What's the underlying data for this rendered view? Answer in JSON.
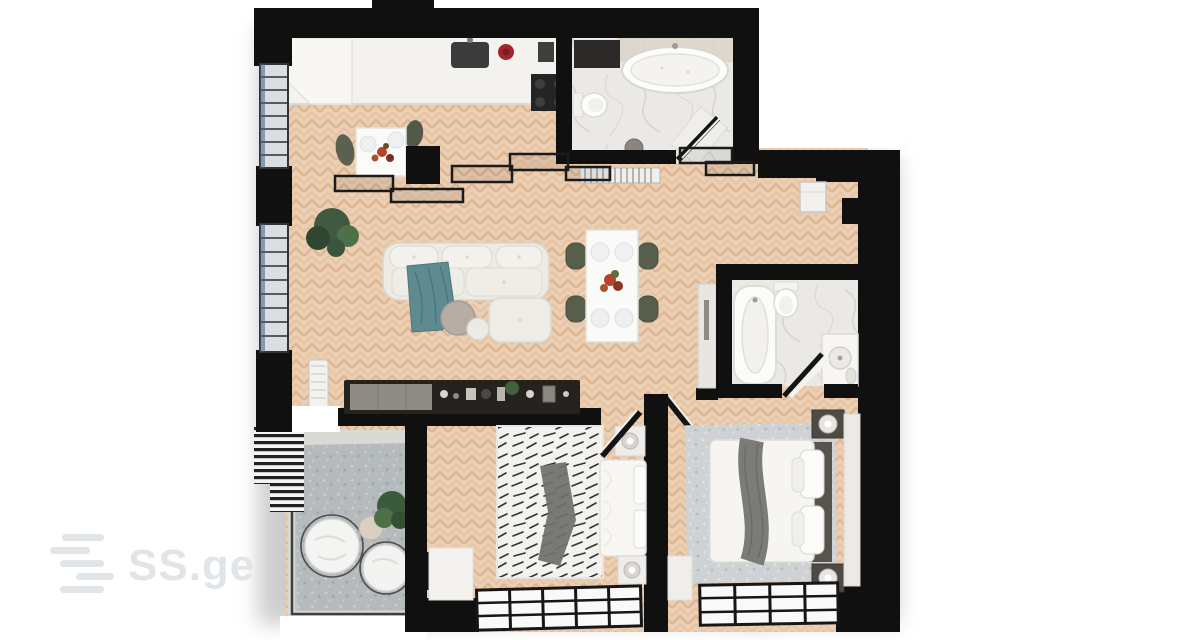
{
  "watermark": {
    "text": "SS.ge",
    "color": "#e2e5e8"
  },
  "scene": {
    "kind": "3d-top-down-floor-plan-render",
    "rooms": [
      {
        "name": "kitchen",
        "furniture": [
          "counter",
          "sink",
          "cooktop",
          "breakfast-table",
          "green-chairs",
          "kettle"
        ]
      },
      {
        "name": "living-room",
        "furniture": [
          "sectional-sofa",
          "teal-throw",
          "coffee-tables",
          "dining-table",
          "dining-chairs",
          "media-console",
          "plant",
          "radiator"
        ]
      },
      {
        "name": "bathroom-top",
        "furniture": [
          "freestanding-oval-tub",
          "toilet",
          "bath-mat",
          "stool",
          "radiator"
        ]
      },
      {
        "name": "entry-hall",
        "furniture": [
          "wall-shelf"
        ]
      },
      {
        "name": "bathroom-side",
        "furniture": [
          "built-in-tub",
          "toilet",
          "vanity-sink",
          "wardrobe"
        ]
      },
      {
        "name": "bedroom-small",
        "furniture": [
          "double-bed",
          "patterned-rug",
          "nightstands",
          "lamps",
          "curtain",
          "window"
        ]
      },
      {
        "name": "bedroom-large",
        "furniture": [
          "double-bed",
          "area-rug",
          "nightstands",
          "lamps",
          "wardrobe",
          "window"
        ]
      },
      {
        "name": "balcony",
        "furniture": [
          "lounge-chairs",
          "side-table",
          "plant",
          "outdoor-rug",
          "pergola-louvers",
          "glass-railing"
        ]
      }
    ]
  },
  "palette": {
    "background": "#ffffff",
    "wall": "#101010",
    "wood": "#eccfb2",
    "wood_line": "#dcb28d",
    "marble": "#ebe9e5",
    "counter": "#f3f2ee",
    "sofa": "#edebe5",
    "accent_teal": "#5d8b91",
    "chair_green": "#575e4b",
    "rug_gray": "#b5babd",
    "console_dark": "#26231f",
    "kettle_red": "#a3242e",
    "glass": "#d8dee2"
  }
}
